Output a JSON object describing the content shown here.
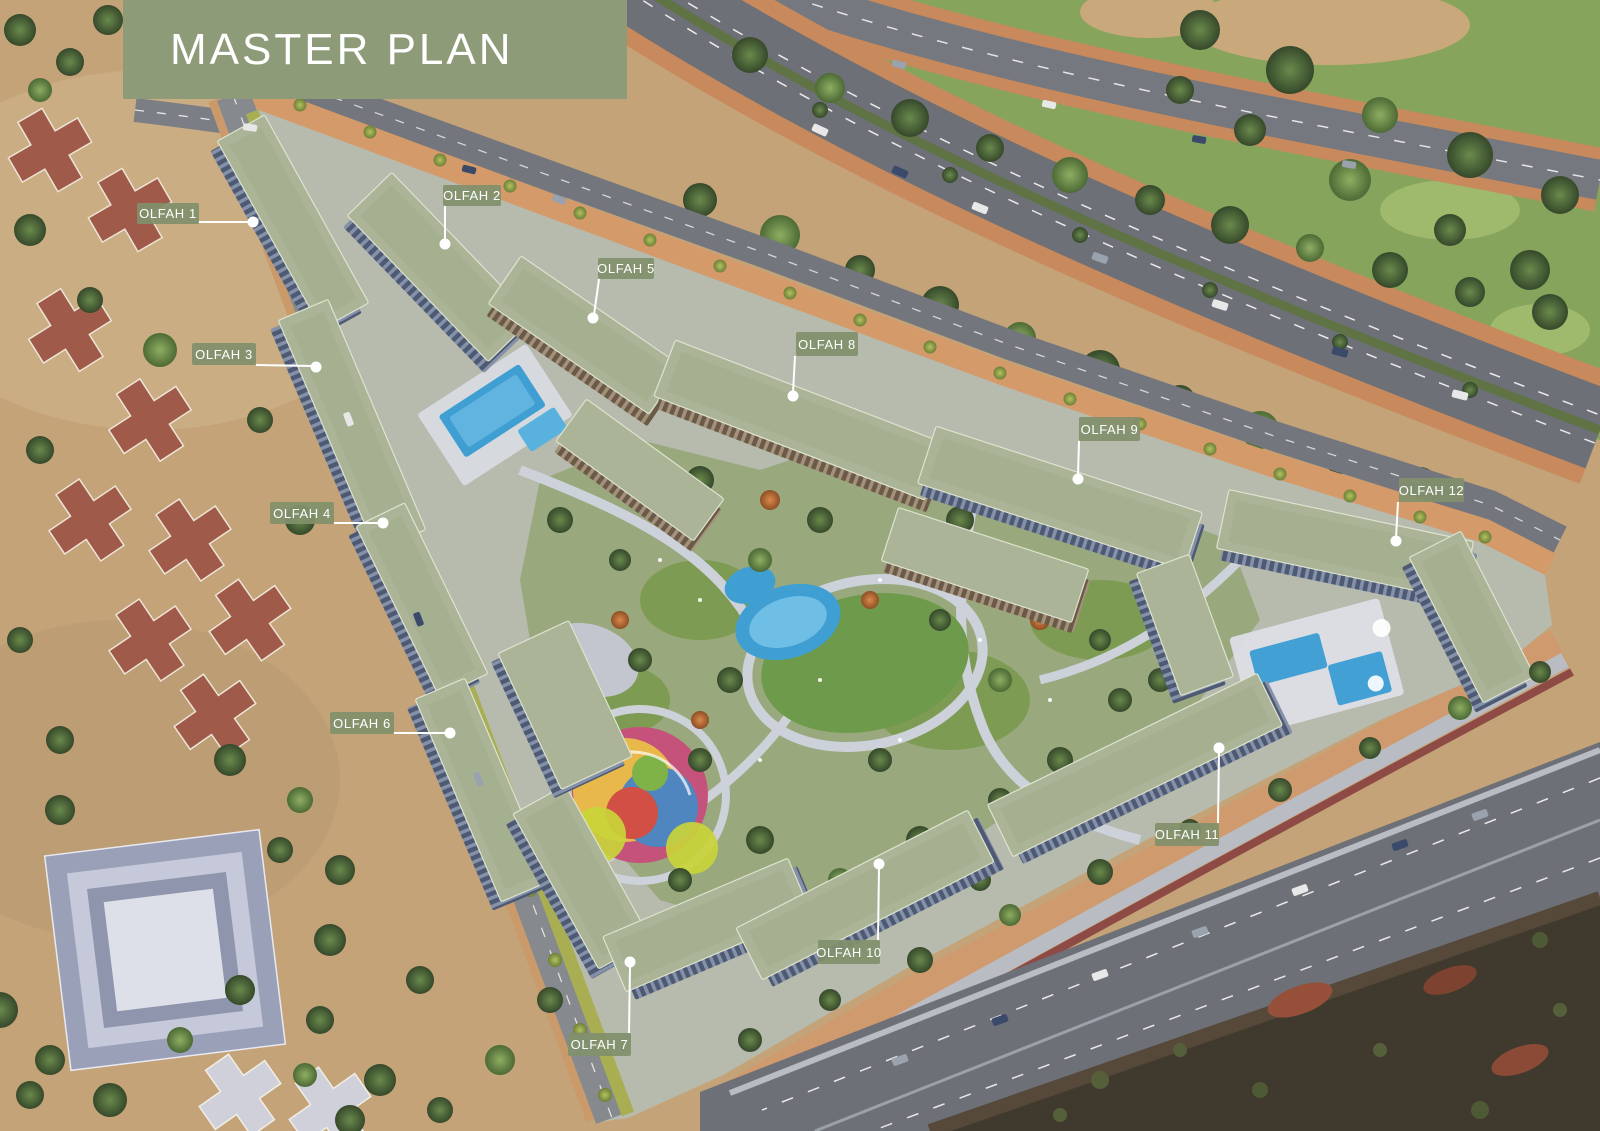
{
  "header": {
    "title": "MASTER PLAN"
  },
  "theme": {
    "banner_bg": "#8d9b79",
    "banner_text": "#ffffff",
    "label_bg": "rgba(129,144,108,0.93)",
    "label_text": "#ffffff",
    "leader": "#ffffff",
    "roof_green": "#abb497",
    "park_green": "#6d9a4b",
    "pool_blue": "#3f9ed2"
  },
  "labels": [
    {
      "text": "OLFAH 1",
      "x": 137,
      "y": 203,
      "w": 62,
      "h": 21,
      "line": [
        198,
        222,
        251,
        222
      ],
      "dot": [
        253,
        222
      ]
    },
    {
      "text": "OLFAH 2",
      "x": 443,
      "y": 185,
      "w": 58,
      "h": 21,
      "line": [
        445,
        206,
        445,
        241
      ],
      "dot": [
        445,
        244
      ]
    },
    {
      "text": "OLFAH 3",
      "x": 192,
      "y": 343,
      "w": 64,
      "h": 22,
      "line": [
        256,
        365,
        313,
        366
      ],
      "dot": [
        316,
        367
      ]
    },
    {
      "text": "OLFAH 4",
      "x": 270,
      "y": 502,
      "w": 64,
      "h": 22,
      "line": [
        334,
        523,
        380,
        523
      ],
      "dot": [
        383,
        523
      ]
    },
    {
      "text": "OLFAH 5",
      "x": 598,
      "y": 258,
      "w": 56,
      "h": 21,
      "line": [
        599,
        279,
        594,
        315
      ],
      "dot": [
        593,
        318
      ]
    },
    {
      "text": "OLFAH 6",
      "x": 330,
      "y": 712,
      "w": 64,
      "h": 22,
      "line": [
        394,
        733,
        447,
        733
      ],
      "dot": [
        450,
        733
      ]
    },
    {
      "text": "OLFAH 7",
      "x": 568,
      "y": 1033,
      "w": 63,
      "h": 23,
      "line": [
        629,
        1033,
        630,
        966
      ],
      "dot": [
        630,
        962
      ]
    },
    {
      "text": "OLFAH 8",
      "x": 796,
      "y": 332,
      "w": 62,
      "h": 24,
      "line": [
        795,
        356,
        793,
        393
      ],
      "dot": [
        793,
        396
      ]
    },
    {
      "text": "OLFAH 9",
      "x": 1079,
      "y": 417,
      "w": 61,
      "h": 24,
      "line": [
        1079,
        441,
        1078,
        476
      ],
      "dot": [
        1078,
        479
      ]
    },
    {
      "text": "OLFAH 10",
      "x": 818,
      "y": 940,
      "w": 62,
      "h": 24,
      "line": [
        878,
        940,
        879,
        868
      ],
      "dot": [
        879,
        864
      ]
    },
    {
      "text": "OLFAH 11",
      "x": 1155,
      "y": 823,
      "w": 64,
      "h": 23,
      "line": [
        1218,
        823,
        1219,
        752
      ],
      "dot": [
        1219,
        748
      ]
    },
    {
      "text": "OLFAH 12",
      "x": 1399,
      "y": 478,
      "w": 65,
      "h": 24,
      "line": [
        1398,
        502,
        1396,
        538
      ],
      "dot": [
        1396,
        541
      ]
    }
  ]
}
